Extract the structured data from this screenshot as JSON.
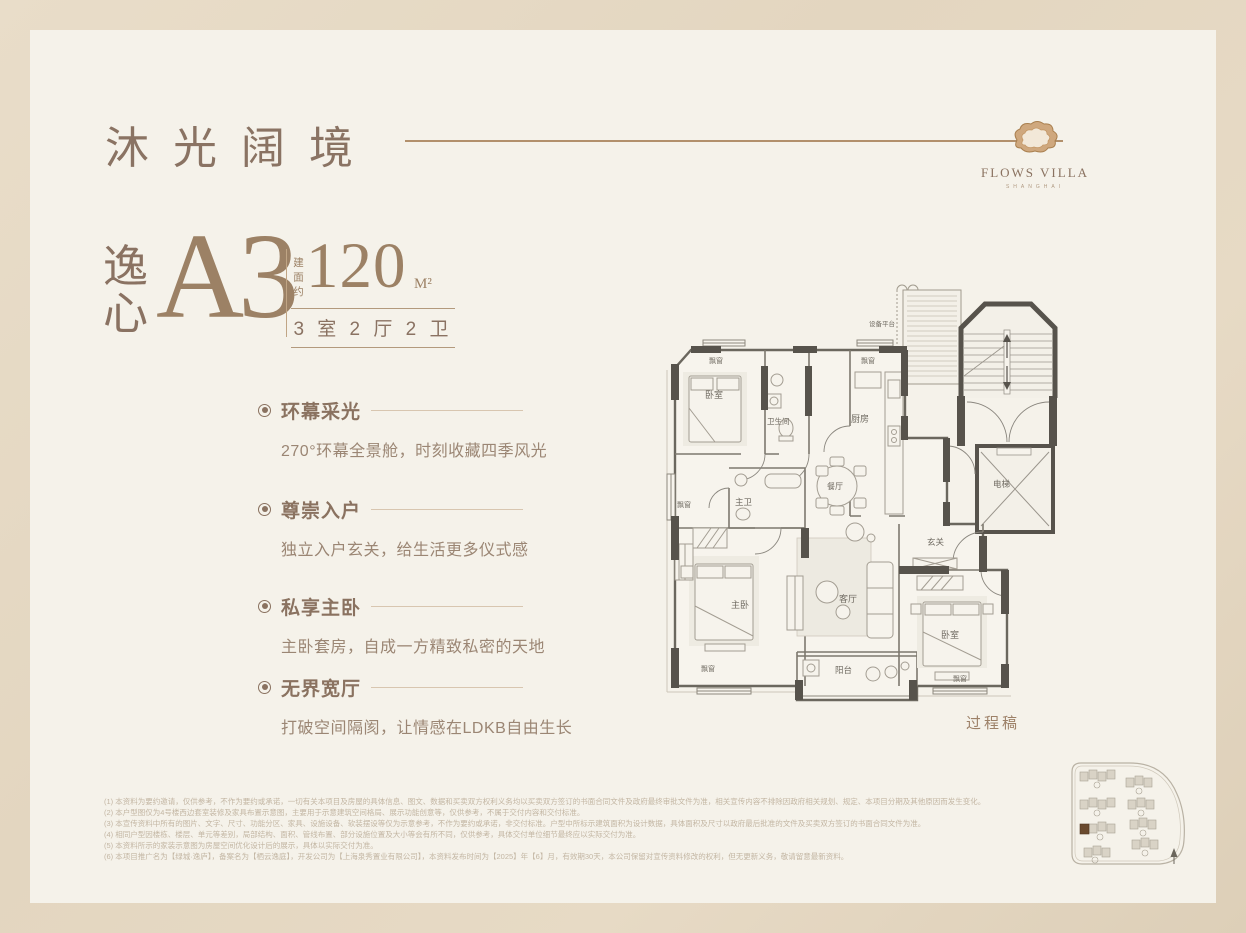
{
  "header": {
    "title": "沐光阔境",
    "logo_name": "FLOWS VILLA",
    "logo_subtitle": "SHANGHAI"
  },
  "unit": {
    "series_name": "逸心",
    "code": "A3",
    "area_label": "建面约",
    "area_value": "120",
    "area_unit": "M²",
    "rooms_summary": "3 室 2 厅 2 卫"
  },
  "features": [
    {
      "title": "环幕采光",
      "desc": "270°环幕全景舱，时刻收藏四季风光"
    },
    {
      "title": "尊崇入户",
      "desc": "独立入户玄关，给生活更多仪式感"
    },
    {
      "title": "私享主卧",
      "desc": "主卧套房，自成一方精致私密的天地"
    },
    {
      "title": "无界宽厅",
      "desc": "打破空间隔阂，让情感在LDKB自由生长"
    }
  ],
  "floorplan": {
    "draft_label": "过程稿",
    "room_labels": [
      "设备平台",
      "飘窗",
      "卧室",
      "卫生间",
      "厨房",
      "飘窗",
      "餐厅",
      "主卫",
      "飘窗",
      "主卧",
      "客厅",
      "玄关",
      "卧室",
      "阳台",
      "飘窗",
      "飘窗",
      "电梯"
    ]
  },
  "disclaimers": [
    "(1) 本资料为要约邀请，仅供参考，不作为要约或承诺，一切有关本项目及房屋的具体信息、图文、数据和买卖双方权利义务均以买卖双方签订的书面合同文件及政府最终审批文件为准，相关宣传内容不排除因政府相关规划、规定、本项目分期及其他原因而发生变化。",
    "(2) 本户型图仅为4号楼西边套室装修及家具布置示意图，主要用于示意建筑空间格局、展示功能创意等，仅供参考，不属于交付内容和交付标准。",
    "(3) 本宣传资料中所有的图片、文字、尺寸、功能分区、家具、设施设备、软装摆设等仅为示意参考，不作为要约或承诺，非交付标准。户型中所标示建筑面积为设计数据，具体面积及尺寸以政府最后批准的文件及买卖双方签订的书面合同文件为准。",
    "(4) 相同户型因楼栋、楼层、单元等差别，局部结构、面积、管线布置、部分设施位置及大小等会有所不同，仅供参考，具体交付单位细节最终应以实际交付为准。",
    "(5) 本资料所示的家装示意图为房屋空间优化设计后的展示，具体以实际交付为准。",
    "(6) 本项目推广名为【绿城·逸庐】，备案名为【栖云逸庭】，开发公司为【上海泉秀置业有限公司】，本资料发布时间为【2025】年【6】月，有效期30天，本公司保留对宣传资料修改的权利，但无更新义务，敬请留意最新资料。"
  ],
  "watermark": "房天下Fang.com",
  "colors": {
    "outer_bg": "#e3d6c0",
    "card_bg": "#f5f2ea",
    "brand_brown": "#8a7363",
    "accent_gold": "#9c8165",
    "rule": "#b2906c",
    "wall": "#57534c",
    "disclaimer_text": "#c3b6a3"
  }
}
